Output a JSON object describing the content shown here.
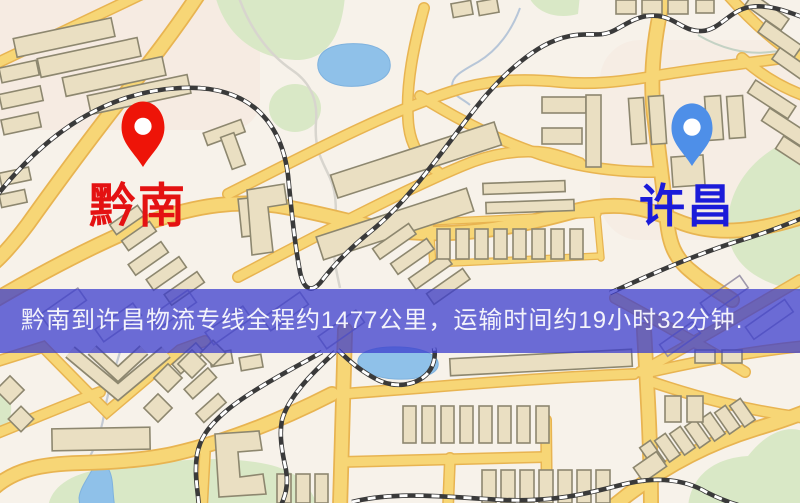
{
  "app": {
    "type": "logistics-route-map",
    "width_px": 800,
    "height_px": 503
  },
  "markers": [
    {
      "id": "origin",
      "label": "黔南",
      "label_color": "#e41212",
      "pin_color": "#ee1408",
      "pin_style": "red-teardrop-pin"
    },
    {
      "id": "destination",
      "label": "许昌",
      "label_color": "#1b1bd9",
      "pin_color": "#4e8fe8",
      "pin_style": "blue-teardrop-pin"
    }
  ],
  "banner": {
    "text": "黔南到许昌物流专线全程约1477公里，运输时间约19小时32分钟.",
    "origin": "黔南",
    "destination": "许昌",
    "service": "物流专线",
    "distance_km": 1477,
    "duration_hours": 19,
    "duration_minutes": 32,
    "background_color": "#3a3ccd",
    "text_color": "#f3f3fb"
  },
  "map": {
    "style": "street-map",
    "colors": {
      "background": "#f7f2ea",
      "road_fill": "#f7d676",
      "road_casing": "#e8b451",
      "building": "#eadfc2",
      "building_outline": "#8d876f",
      "park": "#d9e8c6",
      "water": "#8fc1e9",
      "railway": "#3a3a3a"
    }
  }
}
